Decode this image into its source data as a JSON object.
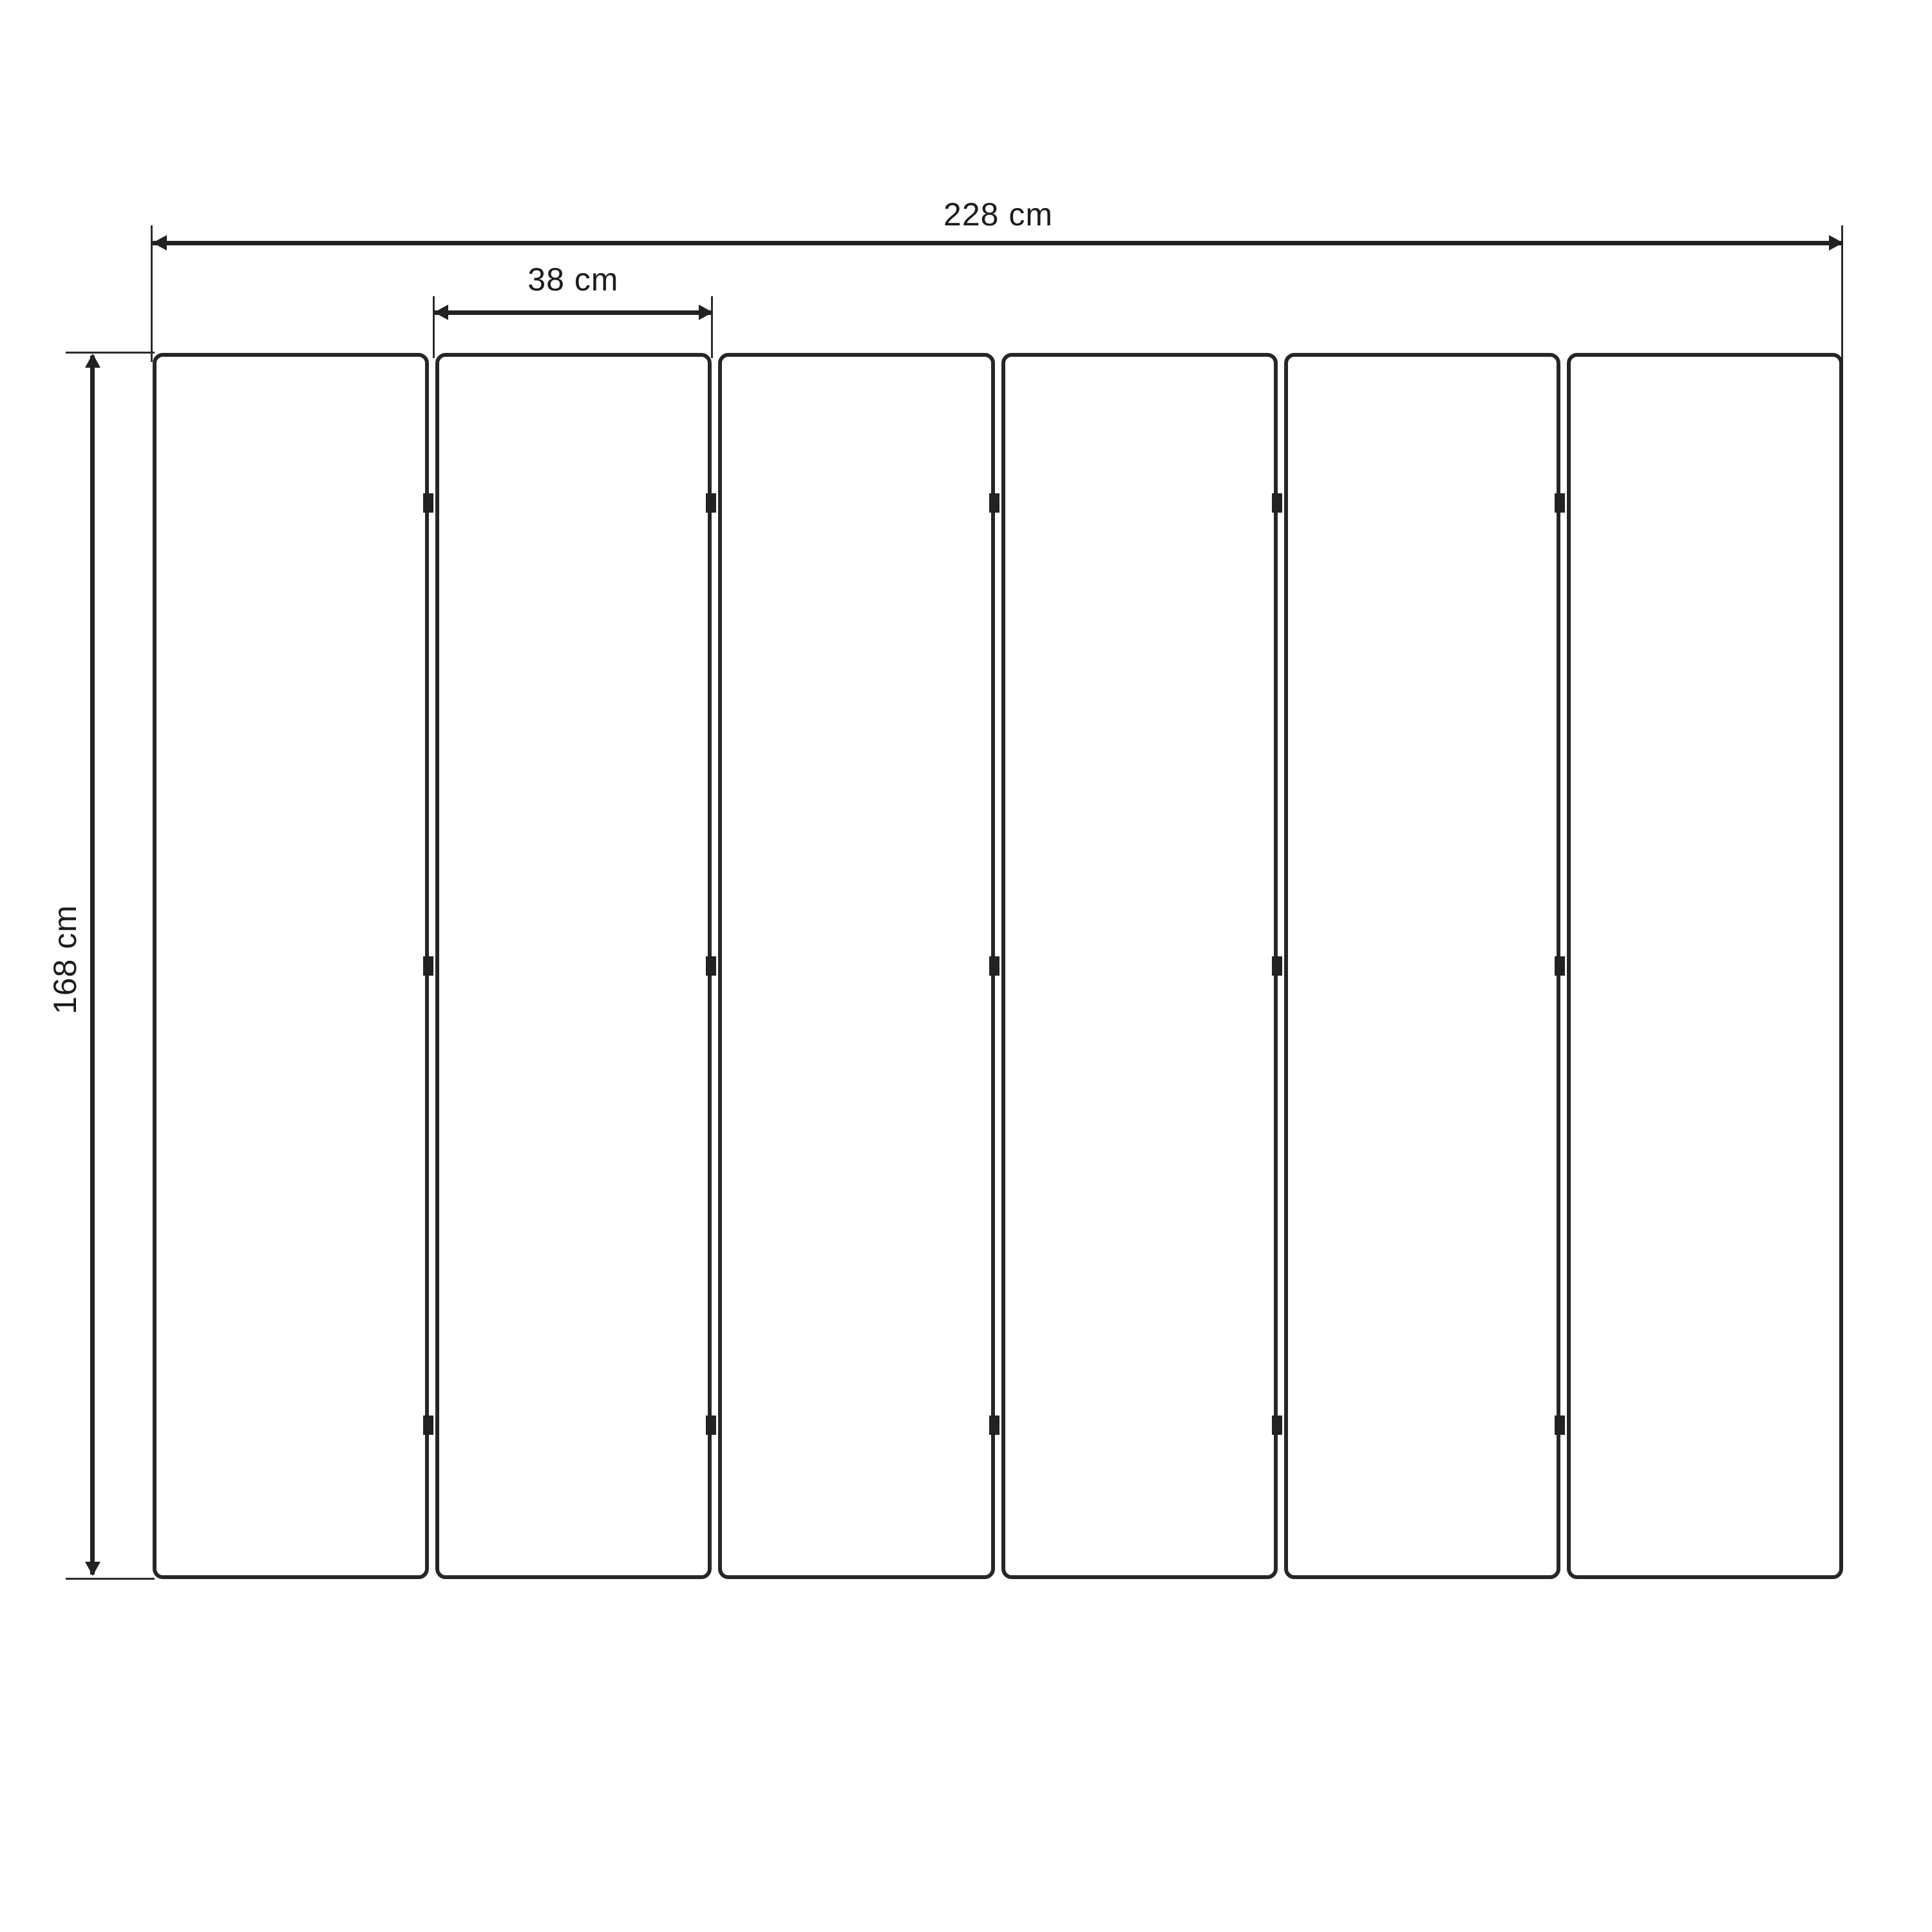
{
  "diagram": {
    "panel_count": 6,
    "hinge_rows_per_gap": 3,
    "labels": {
      "total_width": "228 cm",
      "panel_width": "38 cm",
      "height": "168 cm"
    },
    "colors": {
      "ink": "#222222",
      "background": "#ffffff"
    }
  }
}
